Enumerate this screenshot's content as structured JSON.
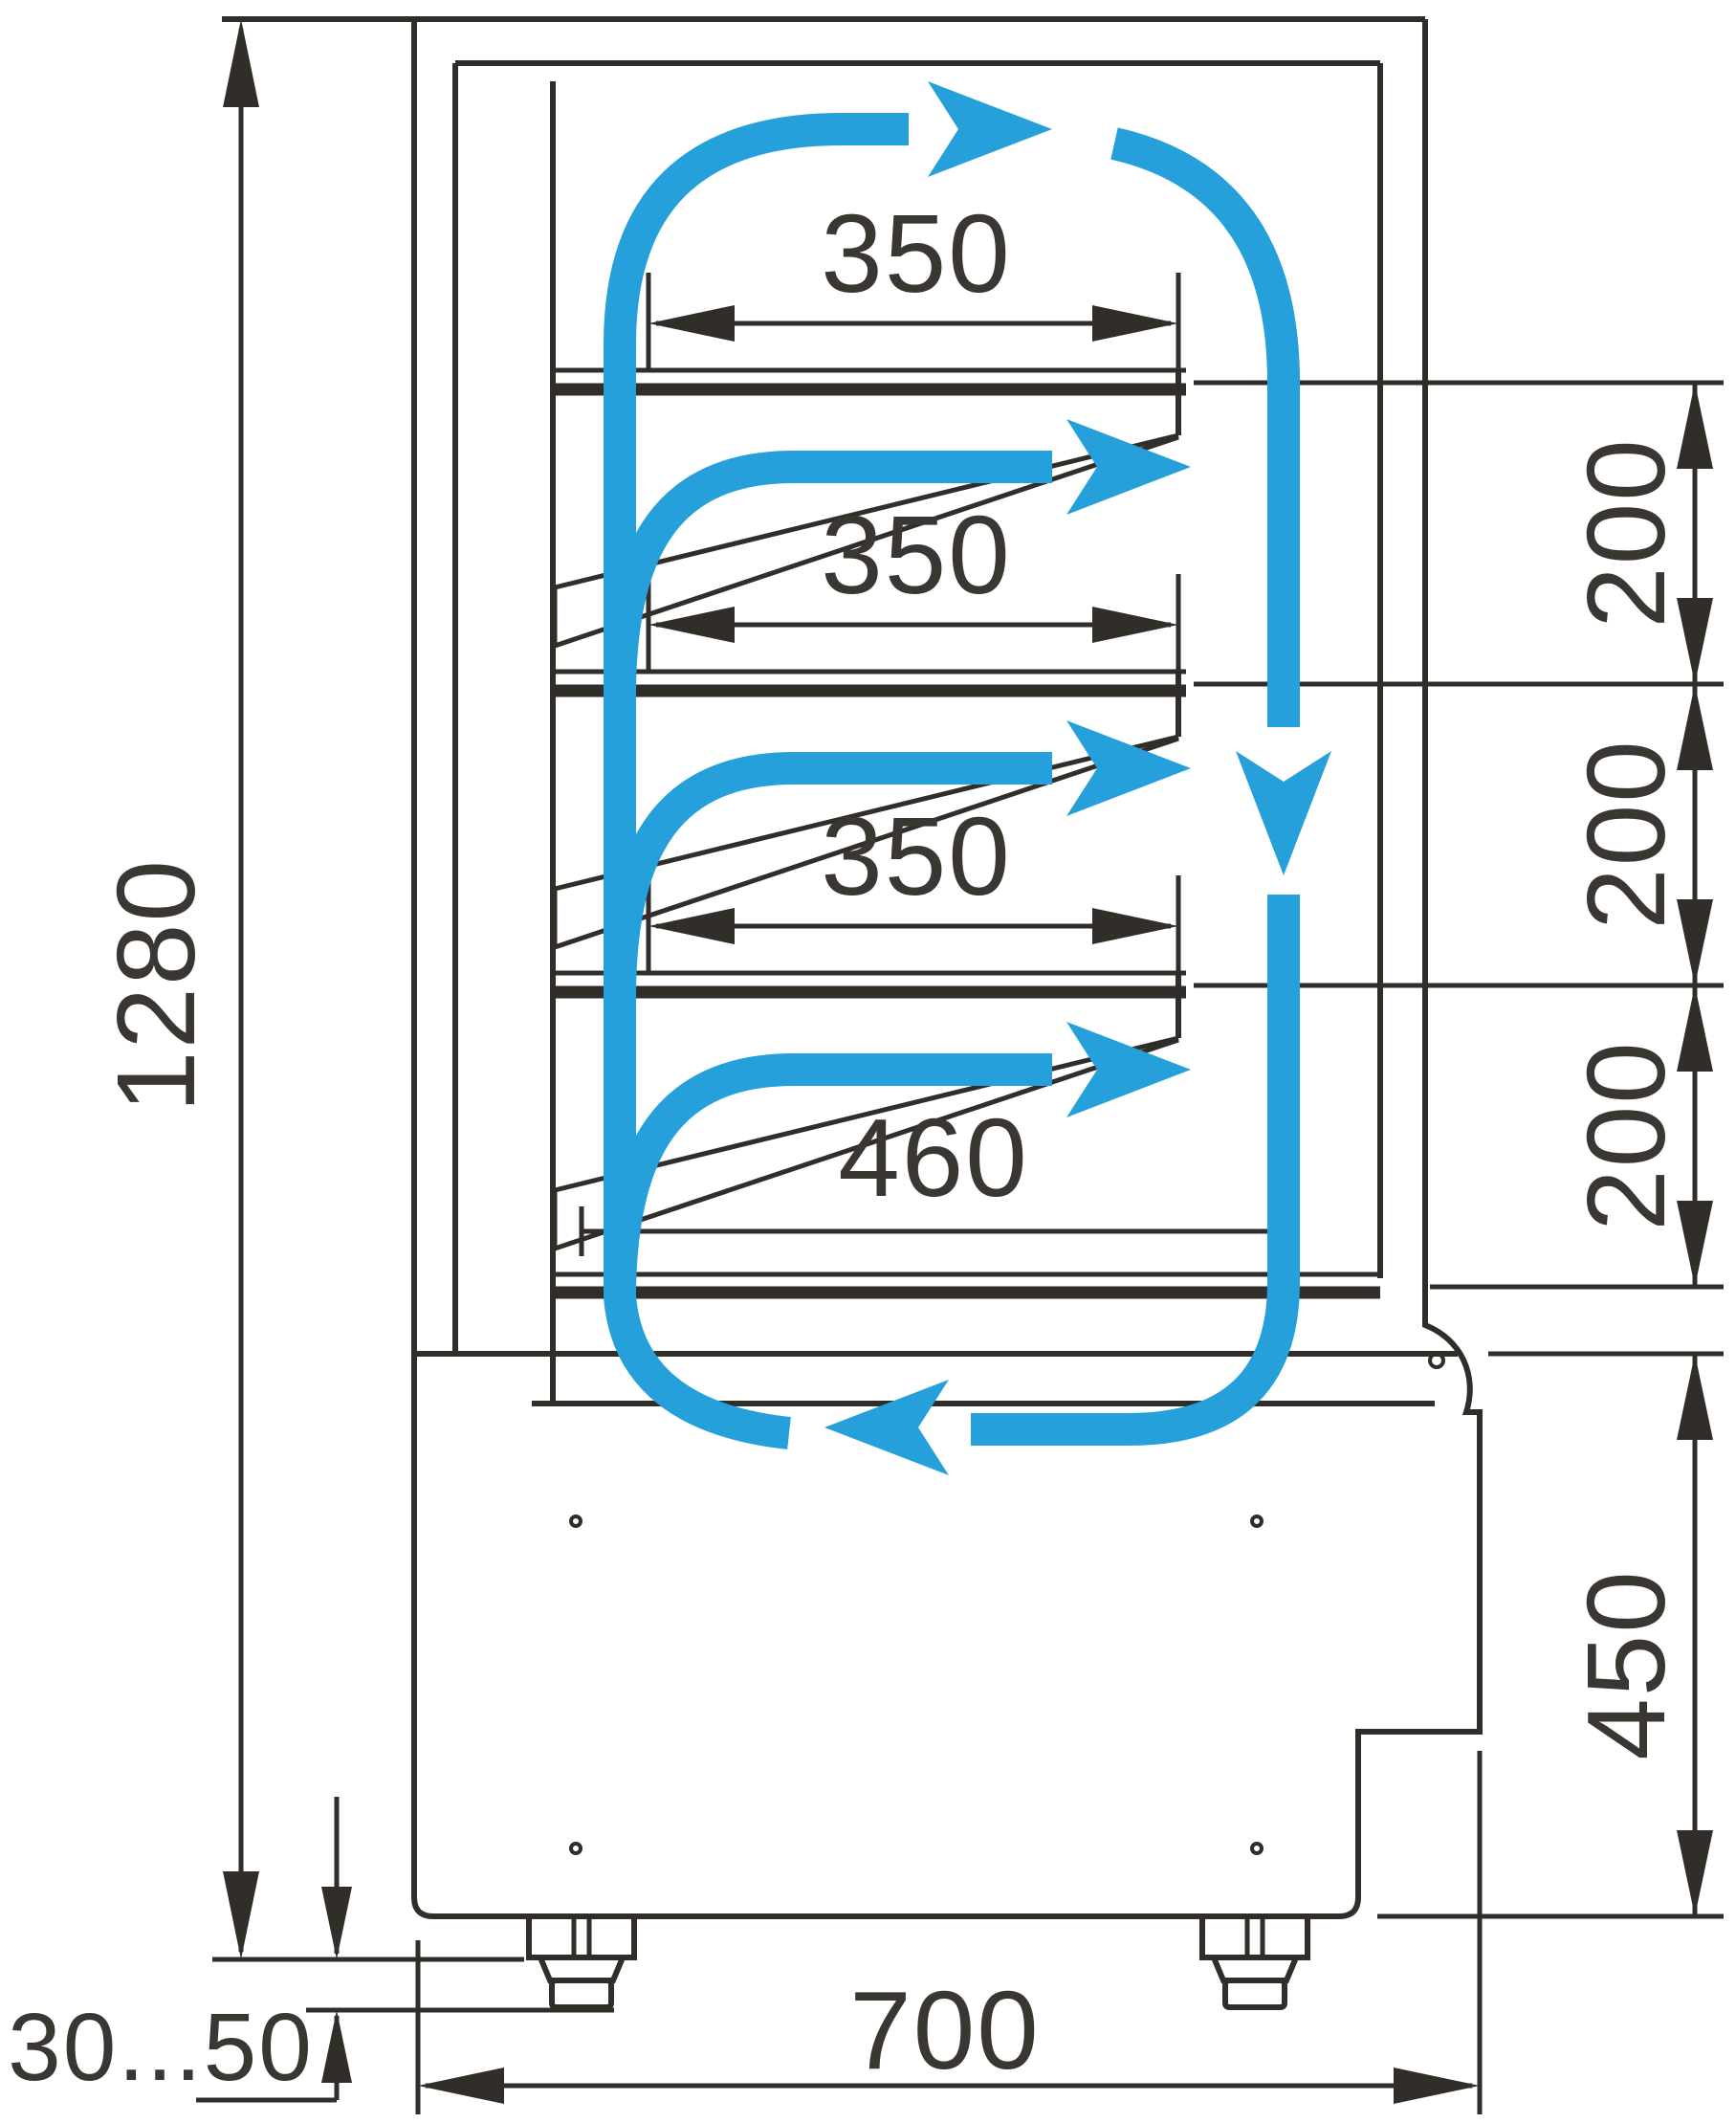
{
  "diagram": {
    "type": "technical-drawing",
    "subject": "refrigerated-display-case-side-section-with-airflow",
    "colors": {
      "airflow": "#25A0DA",
      "line": "#312E2A",
      "text": "#3A3733",
      "background": "#FFFFFF"
    },
    "dimensions": {
      "total_height": "1280",
      "shelf_1_depth": "350",
      "shelf_2_depth": "350",
      "shelf_3_depth": "350",
      "bottom_shelf_depth": "460",
      "shelf_gap_1": "200",
      "shelf_gap_2": "200",
      "shelf_gap_3": "200",
      "base_height": "450",
      "base_depth": "700",
      "foot_adjust_range": "30...50"
    }
  }
}
